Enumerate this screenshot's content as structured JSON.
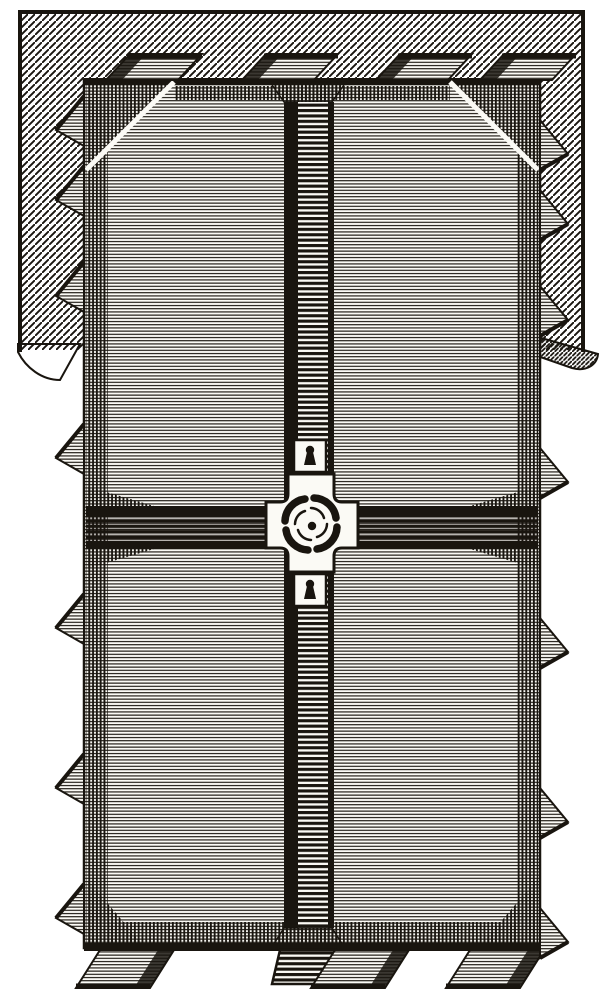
{
  "canvas": {
    "width": 616,
    "height": 1000
  },
  "palette": {
    "ink": "#19150f",
    "paper": "#fbfaf5",
    "page": "#ffffff"
  },
  "engraving": {
    "backdrop": {
      "x": 18,
      "y": 10,
      "w": 567,
      "h": 340,
      "hatch": "diagonal"
    },
    "plate": {
      "x": 84,
      "y": 80,
      "w": 456,
      "h": 868
    },
    "top_tabs_x": [
      104,
      240,
      374,
      478
    ],
    "bottom_tabs_x": [
      100,
      335,
      470
    ],
    "left_teeth_y": [
      96,
      166,
      262,
      424,
      594,
      754,
      884
    ],
    "right_teeth_y": [
      120,
      190,
      286,
      448,
      618,
      788,
      908
    ],
    "vertical_channel": {
      "x": 284,
      "w": 50
    },
    "horizontal_channel": {
      "y": 506,
      "h": 43
    },
    "pinwheel": {
      "cx": 311,
      "cy": 524,
      "blade_count": 4
    },
    "keyholes": [
      {
        "cx": 310,
        "cy": 455
      },
      {
        "cx": 310,
        "cy": 589
      }
    ]
  }
}
